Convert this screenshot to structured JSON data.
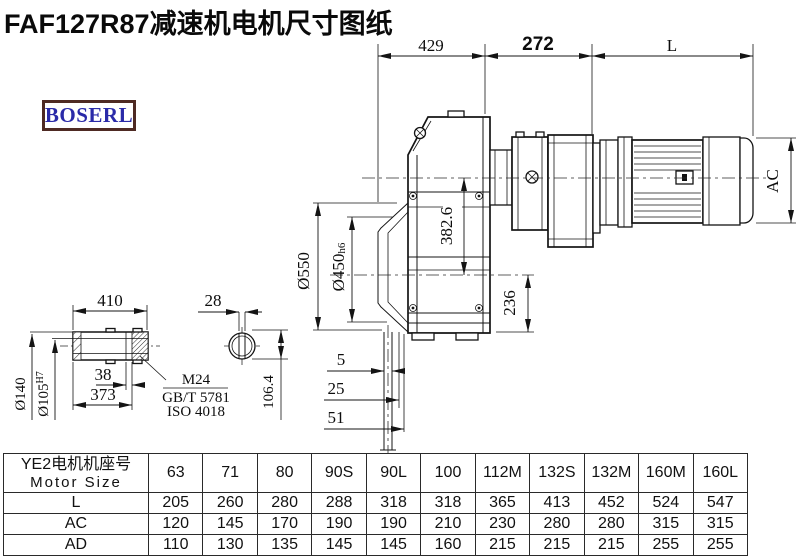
{
  "title": "FAF127R87减速机电机尺寸图纸",
  "logo": {
    "text": "BOSERL"
  },
  "colors": {
    "line": "#141414",
    "logo_border": "#4e2a23",
    "logo_text": "#2a2aa8"
  },
  "drawing": {
    "dims": {
      "top_429": "429",
      "top_272": "272",
      "top_L": "L",
      "ac": "AC",
      "dia550": "Ø550",
      "dia450_base": "Ø450",
      "dia450_tol": "h6",
      "v382": "382.6",
      "v236": "236",
      "b5": "5",
      "b25": "25",
      "b51": "51",
      "shaft_410": "410",
      "shaft_38": "38",
      "shaft_373": "373",
      "key_28": "28",
      "v106": "106.4",
      "dia140": "Ø140",
      "dia105_base": "Ø105",
      "dia105_tol": "H7",
      "note_m24": "M24",
      "note_gbt": "GB/T 5781",
      "note_iso": "ISO 4018"
    }
  },
  "table": {
    "header_cn": "YE2电机机座号",
    "header_en": "Motor Size",
    "columns": [
      "63",
      "71",
      "80",
      "90S",
      "90L",
      "100",
      "112M",
      "132S",
      "132M",
      "160M",
      "160L"
    ],
    "rows": [
      {
        "label": "L",
        "values": [
          "205",
          "260",
          "280",
          "288",
          "318",
          "318",
          "365",
          "413",
          "452",
          "524",
          "547"
        ]
      },
      {
        "label": "AC",
        "values": [
          "120",
          "145",
          "170",
          "190",
          "190",
          "210",
          "230",
          "280",
          "280",
          "315",
          "315"
        ]
      },
      {
        "label": "AD",
        "values": [
          "110",
          "130",
          "135",
          "145",
          "145",
          "160",
          "215",
          "215",
          "215",
          "255",
          "255"
        ]
      }
    ]
  }
}
